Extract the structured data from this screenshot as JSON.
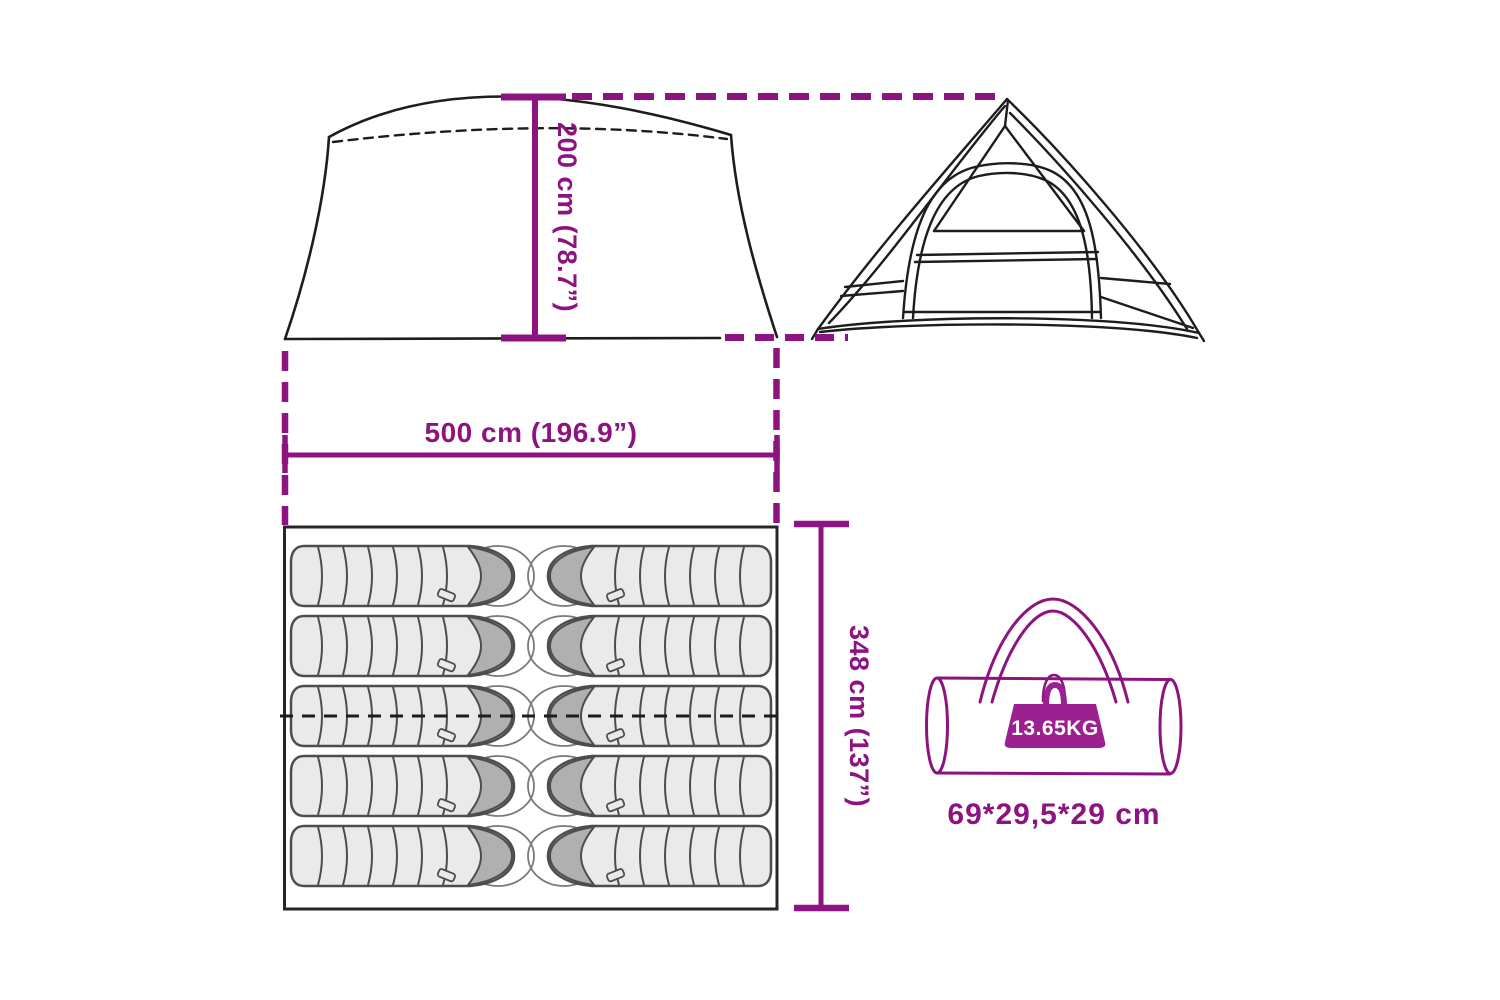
{
  "diagram": {
    "title": "tent-dimension-diagram",
    "accent_color": "#8D1480",
    "line_color": "#1D1D1D",
    "labels": {
      "height": "200 cm (78.7”)",
      "width": "500 cm (196.9”)",
      "depth": "348 cm (137”)"
    },
    "carry_bag": {
      "weight": "13.65KG",
      "size": "69*29,5*29 cm"
    },
    "floor_plan": {
      "sleeping_bag_count": 10,
      "columns": 2,
      "rows": 5
    }
  }
}
